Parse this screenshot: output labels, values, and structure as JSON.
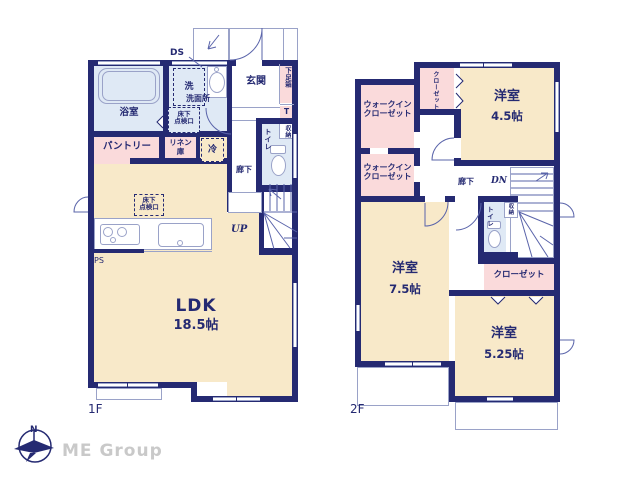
{
  "brand": {
    "name": "ME Group",
    "compass_north": "N"
  },
  "floor1": {
    "label": "1F",
    "duct_label": "DS",
    "stairs_label": "UP",
    "pipe_space_label": "PS",
    "rooms": {
      "ldk": {
        "name": "LDK",
        "size": "18.5帖"
      },
      "bath": "浴室",
      "washroom": "洗面所",
      "laundry": "洗",
      "pantry": "パントリー",
      "linen": {
        "line1": "リネン",
        "line2": "庫"
      },
      "fridge": "冷",
      "entrance": "玄関",
      "shoe_box": "下足箱",
      "shoe_box_t": "T",
      "storage": "収納",
      "toilet": "トイレ",
      "hallway": "廊下",
      "floor_hatch": {
        "line1": "床下",
        "line2": "点検口"
      }
    }
  },
  "floor2": {
    "label": "2F",
    "stairs_label": "DN",
    "rooms": {
      "room_45": {
        "name": "洋室",
        "size": "4.5帖"
      },
      "room_75": {
        "name": "洋室",
        "size": "7.5帖"
      },
      "room_525": {
        "name": "洋室",
        "size": "5.25帖"
      },
      "wic": {
        "line1": "ウォークイン",
        "line2": "クローゼット"
      },
      "closet_top": "クローゼット",
      "closet_mid": "クローゼット",
      "hallway": "廊下",
      "toilet": "トイレ",
      "storage": "収納"
    }
  },
  "colors": {
    "wall": "#252a72",
    "room_cream": "#f8e9c9",
    "room_pink": "#fadadb",
    "room_blue": "#dfe9f5",
    "thin_line": "#9aa2c8",
    "text": "#252a72",
    "brand_gray": "#c9c9c9"
  }
}
